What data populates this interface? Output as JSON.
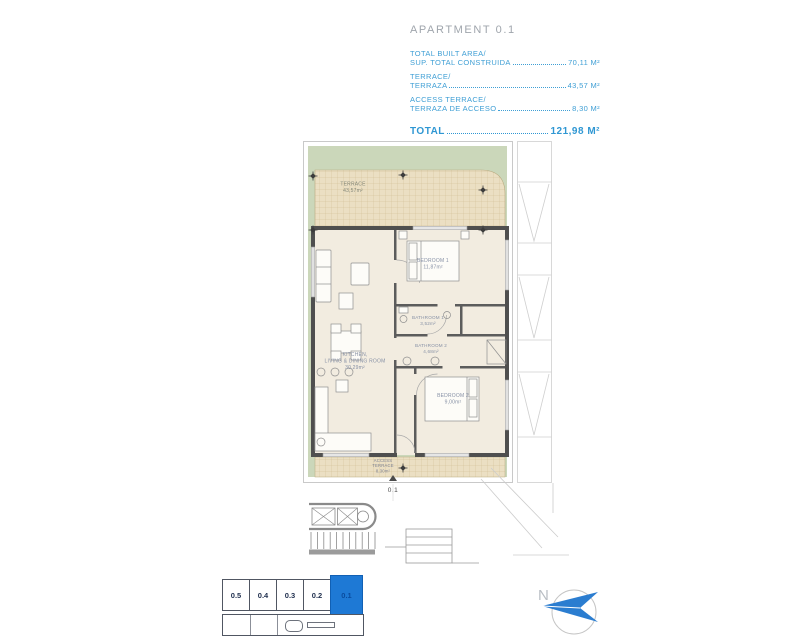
{
  "header": {
    "title": "APARTMENT 0.1",
    "areas": [
      {
        "label_en": "TOTAL BUILT AREA/",
        "label_es": "SUP. TOTAL CONSTRUIDA",
        "value": "70,11 M²"
      },
      {
        "label_en": "TERRACE/",
        "label_es": "TERRAZA",
        "value": "43,57 M²"
      },
      {
        "label_en": "ACCESS TERRACE/",
        "label_es": "TERRAZA DE ACCESO",
        "value": "8,30 M²"
      }
    ],
    "total_label": "TOTAL",
    "total_value": "121,98 M²"
  },
  "plan": {
    "terrace": {
      "name": "TERRACE",
      "area": "43,57m²"
    },
    "bedroom1": {
      "name": "BEDROOM 1",
      "area": "11,87m²"
    },
    "bathroom1": {
      "name": "BATHROOM 1",
      "area": "3,52m²"
    },
    "bathroom2": {
      "name": "BATHROOM 2",
      "area": "4,68m²"
    },
    "living": {
      "name1": "KITCHEN,",
      "name2": "LIVING & DINING ROOM",
      "area": "30,29m²"
    },
    "bedroom2": {
      "name": "BEDROOM 2",
      "area": "9,00m²"
    },
    "access_terrace": {
      "name1": "ACCESS",
      "name2": "TERRACE",
      "area": "8,30m²"
    },
    "entry_label": "0.1"
  },
  "keyplan": {
    "units": [
      "0.5",
      "0.4",
      "0.3",
      "0.2",
      "0.1"
    ],
    "selected_unit": "0.1"
  },
  "compass": {
    "north_label": "N"
  },
  "colors": {
    "accent_blue": "#3f9fd5",
    "keyplan_blue": "#1e79d5",
    "garden_green": "#cbd7ba",
    "tile_beige": "#ebdfc3",
    "floor_cream": "#f2ece0",
    "wall_gray": "#4f4f4f"
  }
}
